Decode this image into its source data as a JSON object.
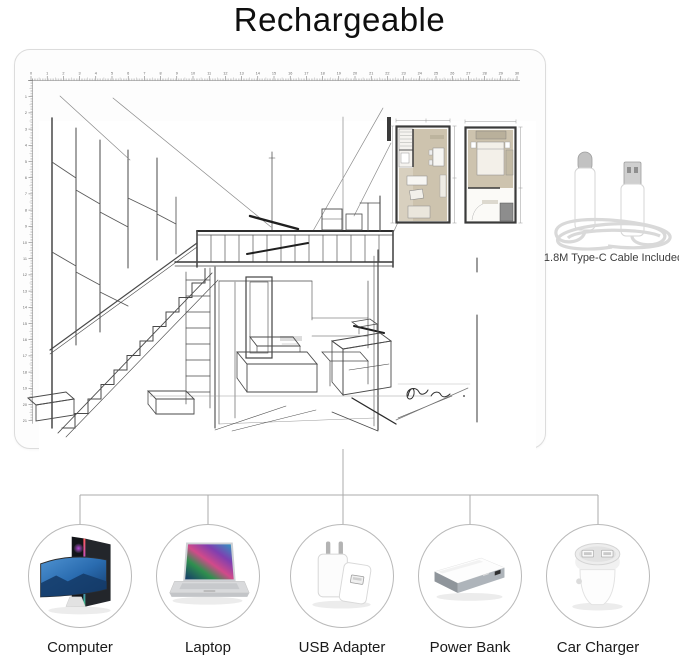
{
  "title": "Rechargeable",
  "light_pad": {
    "ruler_top": {
      "start": 0,
      "end": 30
    },
    "ruler_left": {
      "start": 0,
      "end": 21
    }
  },
  "cable": {
    "caption": "1.8M Type-C Cable Included"
  },
  "power_sources": [
    {
      "label": "Computer",
      "icon": "desktop-computer-icon"
    },
    {
      "label": "Laptop",
      "icon": "laptop-icon"
    },
    {
      "label": "USB Adapter",
      "icon": "usb-wall-adapter-icon"
    },
    {
      "label": "Power Bank",
      "icon": "power-bank-icon"
    },
    {
      "label": "Car Charger",
      "icon": "car-charger-icon"
    }
  ],
  "colors": {
    "connector_line": "#ababab",
    "circle_border": "#b9b9b9",
    "pad_border": "#dcdcdc",
    "sketch_ink": "#3f3f3f",
    "floorplan_fill": "#cdc3ae"
  }
}
